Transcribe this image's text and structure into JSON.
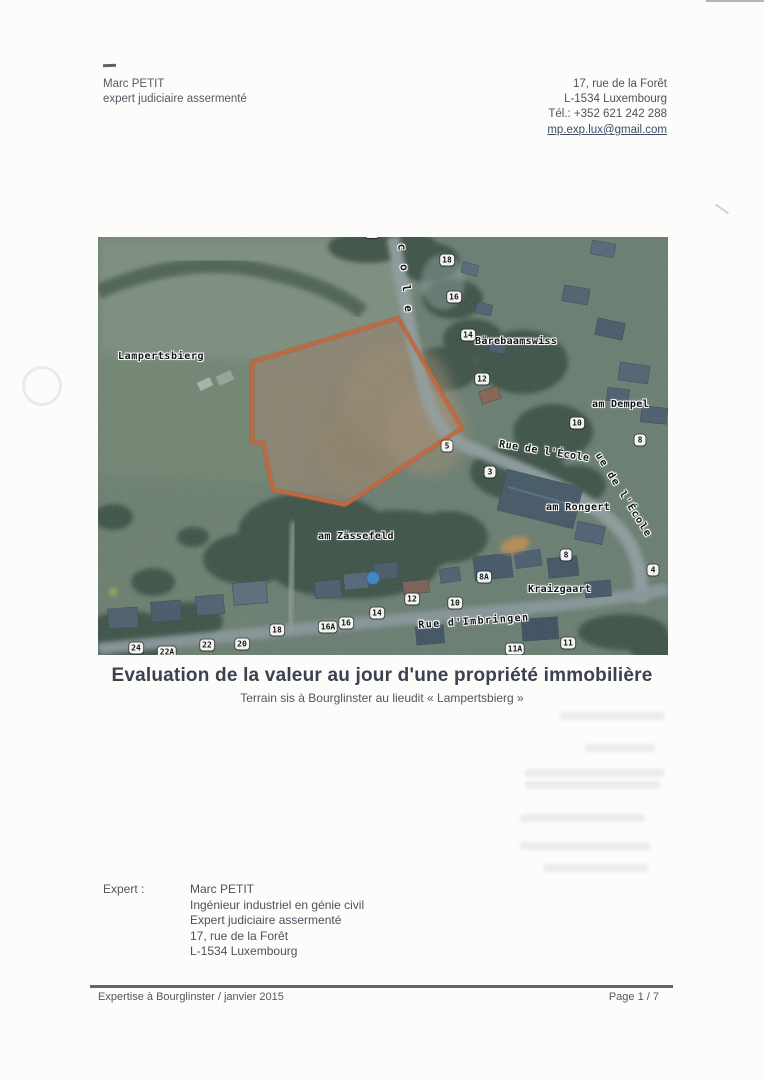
{
  "header": {
    "left_lines": [
      "Marc PETIT",
      "expert judiciaire assermenté"
    ],
    "right_lines": [
      "17, rue de la Forêt",
      "L-1534 Luxembourg",
      "Tél.: +352 621 242 288"
    ],
    "email": "mp.exp.lux@gmail.com"
  },
  "title": "Evaluation de la valeur au jour d'une propriété immobilière",
  "subtitle": "Terrain sis à Bourglinster au lieudit « Lampertsbierg »",
  "expert": {
    "label": "Expert :",
    "lines": [
      "Marc PETIT",
      "Ingénieur industriel en génie civil",
      "Expert judiciaire assermenté",
      "17, rue de la Forêt",
      "L-1534 Luxembourg"
    ]
  },
  "footer": {
    "left": "Expertise à Bourglinster / janvier 2015",
    "right": "Page 1 / 7"
  },
  "map": {
    "parcel_outline_color": "#d95b26",
    "labels": [
      {
        "text": "Lampertsbierg",
        "x": 20,
        "y": 114,
        "rot": 0,
        "ls": 0.6
      },
      {
        "text": "cole",
        "x": 310,
        "y": 6,
        "rot": 84,
        "ls": 14,
        "fs": 11
      },
      {
        "text": "Bärebaamswiss",
        "x": 377,
        "y": 99,
        "rot": 0,
        "ls": 0.3
      },
      {
        "text": "am Dempel",
        "x": 494,
        "y": 162,
        "rot": 0,
        "ls": 0.3
      },
      {
        "text": "Rue de l'École",
        "x": 402,
        "y": 202,
        "rot": 9,
        "ls": 0.5
      },
      {
        "text": "ue de l'École",
        "x": 504,
        "y": 214,
        "rot": 58,
        "ls": 1.5
      },
      {
        "text": "am Rongert",
        "x": 448,
        "y": 265,
        "rot": 0,
        "ls": 0.4
      },
      {
        "text": "am Zässefeld",
        "x": 220,
        "y": 294,
        "rot": 0,
        "ls": 0.3
      },
      {
        "text": "Kraizgaart",
        "x": 430,
        "y": 347,
        "rot": 0,
        "ls": 0.3
      },
      {
        "text": "Rue d'Imbringen",
        "x": 320,
        "y": 383,
        "rot": -4,
        "ls": 1.4
      }
    ],
    "house_numbers": [
      {
        "n": "",
        "x": 274,
        "y": 0
      },
      {
        "n": "18",
        "x": 349,
        "y": 23
      },
      {
        "n": "16",
        "x": 356,
        "y": 60
      },
      {
        "n": "14",
        "x": 370,
        "y": 98
      },
      {
        "n": "12",
        "x": 384,
        "y": 142
      },
      {
        "n": "10",
        "x": 479,
        "y": 186
      },
      {
        "n": "8",
        "x": 542,
        "y": 203
      },
      {
        "n": "5",
        "x": 349,
        "y": 209
      },
      {
        "n": "3",
        "x": 392,
        "y": 235
      },
      {
        "n": "8",
        "x": 468,
        "y": 318
      },
      {
        "n": "4",
        "x": 555,
        "y": 333
      },
      {
        "n": "8A",
        "x": 386,
        "y": 340
      },
      {
        "n": "12",
        "x": 314,
        "y": 362
      },
      {
        "n": "10",
        "x": 357,
        "y": 366
      },
      {
        "n": "14",
        "x": 279,
        "y": 376
      },
      {
        "n": "16",
        "x": 248,
        "y": 386
      },
      {
        "n": "16A",
        "x": 230,
        "y": 390
      },
      {
        "n": "18",
        "x": 179,
        "y": 393
      },
      {
        "n": "11",
        "x": 470,
        "y": 406
      },
      {
        "n": "20",
        "x": 144,
        "y": 407
      },
      {
        "n": "22",
        "x": 109,
        "y": 408
      },
      {
        "n": "24",
        "x": 38,
        "y": 411
      },
      {
        "n": "11A",
        "x": 417,
        "y": 412
      },
      {
        "n": "22A",
        "x": 69,
        "y": 415
      }
    ]
  }
}
